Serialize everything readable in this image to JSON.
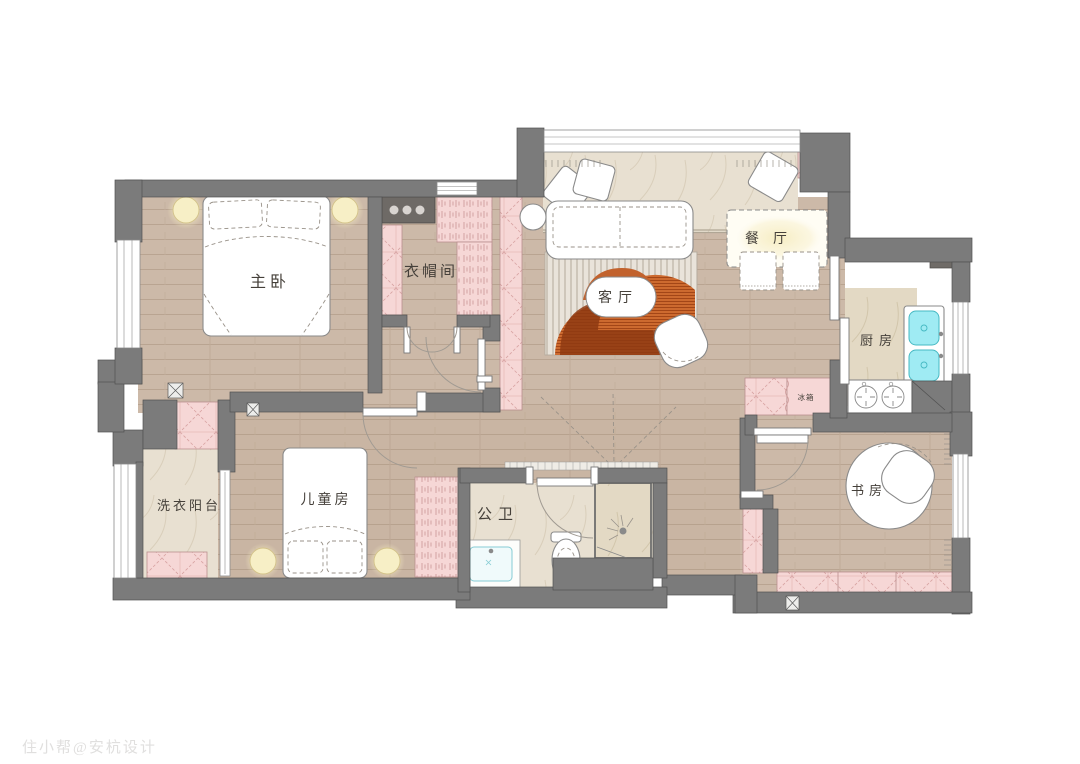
{
  "plan_title_note": "residential floor plan",
  "rooms": {
    "master_bedroom": {
      "label": "主卧"
    },
    "cloakroom": {
      "label": "衣帽间"
    },
    "living_room": {
      "label": "客厅"
    },
    "dining_room": {
      "label": "餐厅"
    },
    "kitchen": {
      "label": "厨房"
    },
    "refrigerator": {
      "label": "冰箱"
    },
    "study": {
      "label": "书房"
    },
    "bathroom": {
      "label": "公卫"
    },
    "kids_room": {
      "label": "儿童房"
    },
    "laundry_balcony": {
      "label": "洗衣阳台"
    }
  },
  "watermark": {
    "text": "住小帮@安杭设计"
  },
  "colors": {
    "wall": "#7b7b7b",
    "wood_floor": "#ccb9a8",
    "stone_floor": "#e8e0d1",
    "cabinet_pink": "#f6d7d6",
    "sink_cyan": "#9febf3",
    "rug_orange": "#c2622d",
    "rug_rust": "#a34617",
    "lamp_yellow": "#f7efc6",
    "label_text": "#45403a"
  }
}
